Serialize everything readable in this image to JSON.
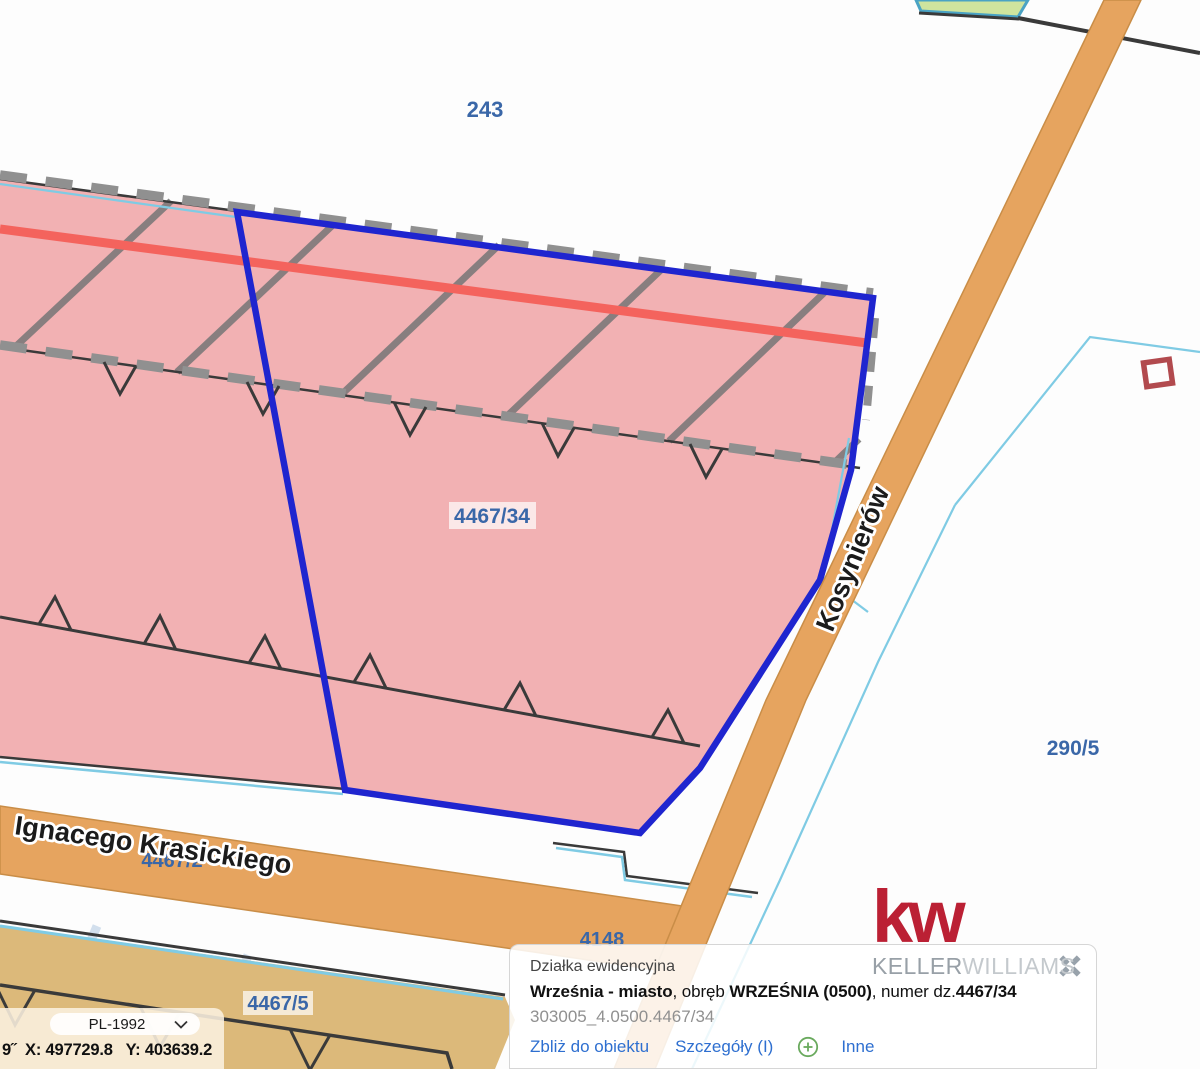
{
  "colors": {
    "pink": "#f2b1b3",
    "red-line": "#f4635d",
    "selection-blue": "#1f25cf",
    "hatch-gray": "#757575",
    "dash-gray": "#909090",
    "dark-line": "#3a3a3a",
    "cyan": "#7fcbe4",
    "teal-border": "#4aa3c4",
    "street-fill": "#e6a45f",
    "street-border": "#c98d47",
    "tan": "#dcb97a",
    "green": "#cfe49e",
    "label-blue": "#3a67a8",
    "link-blue": "#2e6fd0",
    "kw-red": "#bb2034",
    "keller-gray": "#98a0a7",
    "williams-gray": "#c4c9cd",
    "panel-cream": "rgba(250,240,223,0.88)",
    "popup-bg": "rgba(255,255,255,0.86)",
    "muted-text": "#909090",
    "plus-green": "#6aaa5e"
  },
  "map": {
    "labels": {
      "parcel_243": "243",
      "parcel_4467_34": "4467/34",
      "parcel_290_5": "290/5",
      "parcel_4467_5": "4467/5",
      "parcel_4148": "4148",
      "parcel_4467_2": "4467/2",
      "street_kosynierow": "Kosynierów",
      "street_krasickiego": "Ignacego Krasickiego"
    }
  },
  "popup": {
    "title": "Działka ewidencyjna",
    "area_bold": "Września - miasto",
    "obreb_mid": ", obręb ",
    "obreb_bold": "WRZEŚNIA (0500)",
    "numer_mid": ", numer dz.",
    "numer_bold": "4467/34",
    "id_line": "303005_4.0500.4467/34",
    "links": {
      "zoom_to": "Zbliż do obiektu",
      "details": "Szczegóły (I)",
      "other": "Inne"
    }
  },
  "logo": {
    "kw": "kw",
    "keller": "KELLER",
    "williams": "WILLIAMS"
  },
  "coords_bar": {
    "crs": "PL-1992",
    "coords_text": "9˝  X: 497729.8   Y: 403639.2"
  }
}
